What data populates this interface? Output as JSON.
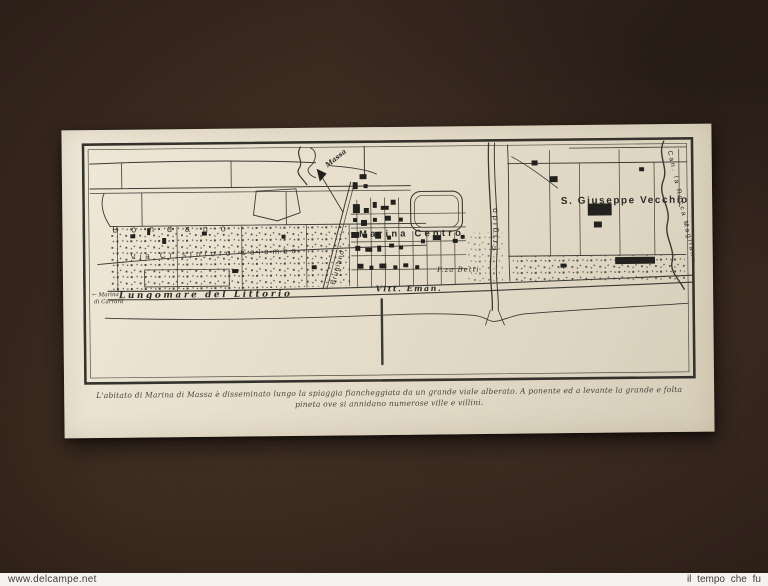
{
  "photo": {
    "watermark_left": "www.delcampe.net",
    "watermark_right": "il tempo che fu"
  },
  "map": {
    "labels": {
      "bondano": "Bondano",
      "via_colombo": "Via Cristoforo Colombo",
      "marina_centro": "Marina Centro",
      "s_giuseppe_vecchio": "S. Giuseppe Vecchio",
      "lungomare_littorio": "Lungomare del Littorio",
      "vitt_eman": "Vitt. Eman.",
      "piazza_betti": "P.za Betti",
      "frigido": "Frigido",
      "brugiano": "Brugiano",
      "canale_magliano": "Can. la Rocca Magliano",
      "massa": "Massa",
      "marina_carrara_1": "← Marina",
      "marina_carrara_2": "di Carrara"
    },
    "caption_line1": "L'abitato di Marina di Massa è disseminato lungo la spiaggia fiancheggiata da un grande viale alberato. A ponente ed a levante la grande e folta",
    "caption_line2": "pineta ove si annidano numerose ville e villini."
  },
  "colors": {
    "background": "#392a20",
    "paper": "#e7dfcc",
    "ink": "#34322c",
    "watermark_bar": "#f4f3f0"
  }
}
